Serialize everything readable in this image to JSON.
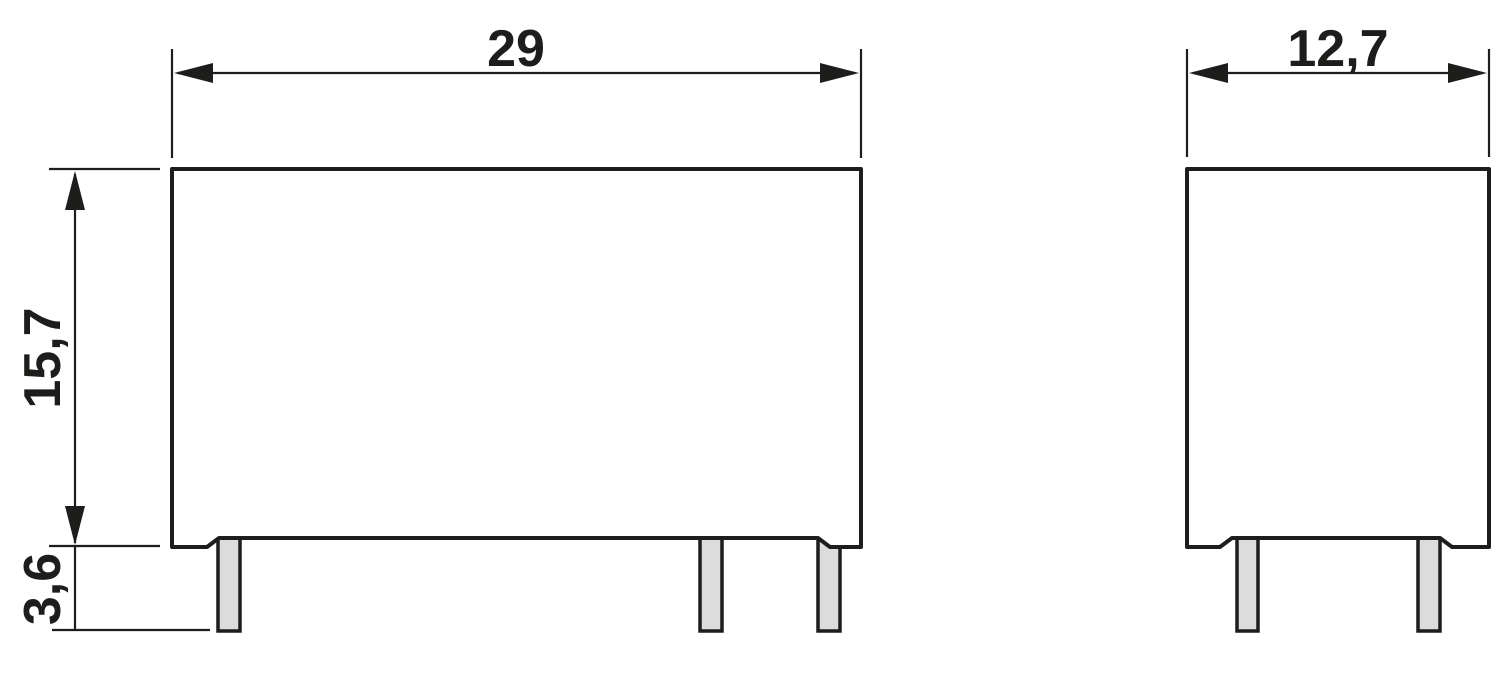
{
  "drawing": {
    "type": "technical-dimension-drawing-two-views",
    "decimal_style": "comma",
    "colors": {
      "line": "#1D1D1B",
      "pin-fill": "#DCDCDC",
      "background": "#FFFFFF"
    }
  },
  "dimensions": {
    "front_width": "29",
    "body_height": "15,7",
    "pin_length": "3,6",
    "side_width": "12,7"
  },
  "views": {
    "front": {
      "pin_count": 3
    },
    "side": {
      "pin_count": 2
    }
  }
}
